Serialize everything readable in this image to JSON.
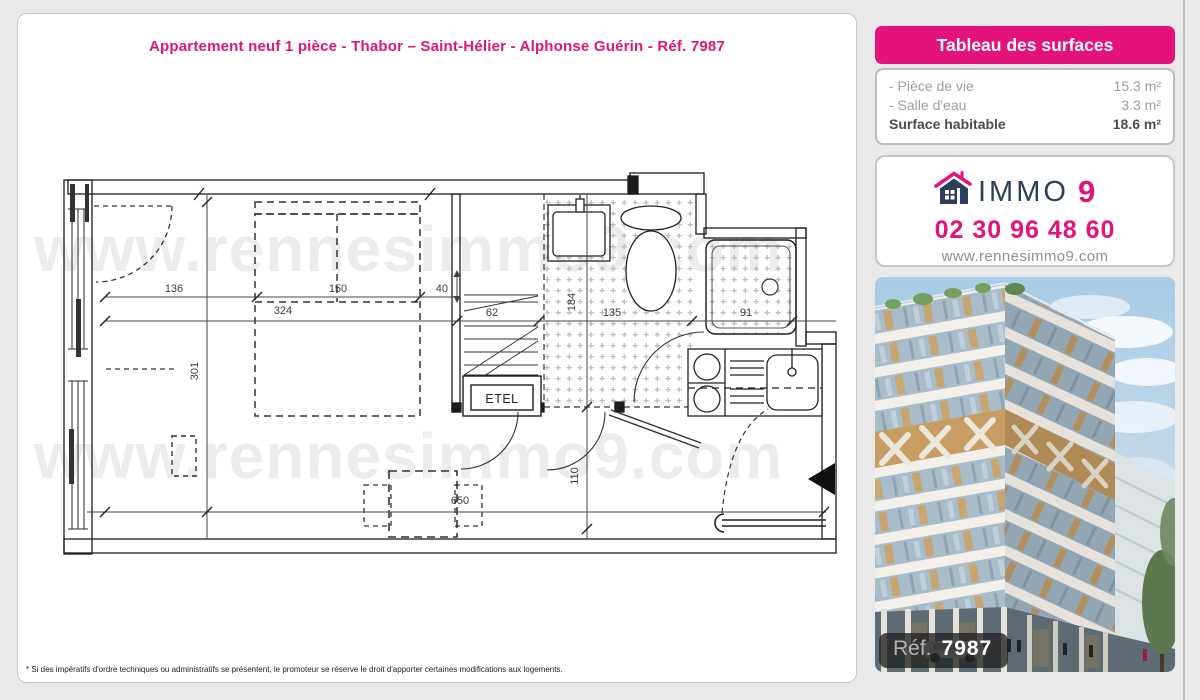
{
  "page": {
    "title": "Appartement neuf 1 pièce - Thabor – Saint-Hélier - Alphonse Guérin - Réf. 7987",
    "footnote": "* Si des impératifs d'ordre techniques ou administratifs se présentent, le promoteur se réserve le droit d'apporter certaines modifications aux logements."
  },
  "surfaces": {
    "header": "Tableau des surfaces",
    "rows": [
      {
        "label": "- Pièce de vie",
        "value": "15.3 m²"
      },
      {
        "label": "- Salle d'eau",
        "value": "3.3 m²"
      }
    ],
    "total_label": "Surface habitable",
    "total_value": "18.6 m²"
  },
  "agency": {
    "brand_text": "IMMO",
    "brand_digit": "9",
    "phone": "02 30 96 48 60",
    "website": "www.rennesimmo9.com"
  },
  "photo": {
    "ref_label": "Réf.",
    "ref_value": "7987"
  },
  "floorplan": {
    "watermark": "www.rennesimmo9.com",
    "etel": "ETEL",
    "dims": {
      "d136": "136",
      "d150": "150",
      "d40": "40",
      "d324": "324",
      "d301": "301",
      "d62": "62",
      "d184": "184",
      "d135": "135",
      "d91": "91",
      "d650": "650",
      "d110": "110"
    }
  },
  "colors": {
    "accent_pink": "#e4127b",
    "brand_navy": "#2d3e5c"
  }
}
